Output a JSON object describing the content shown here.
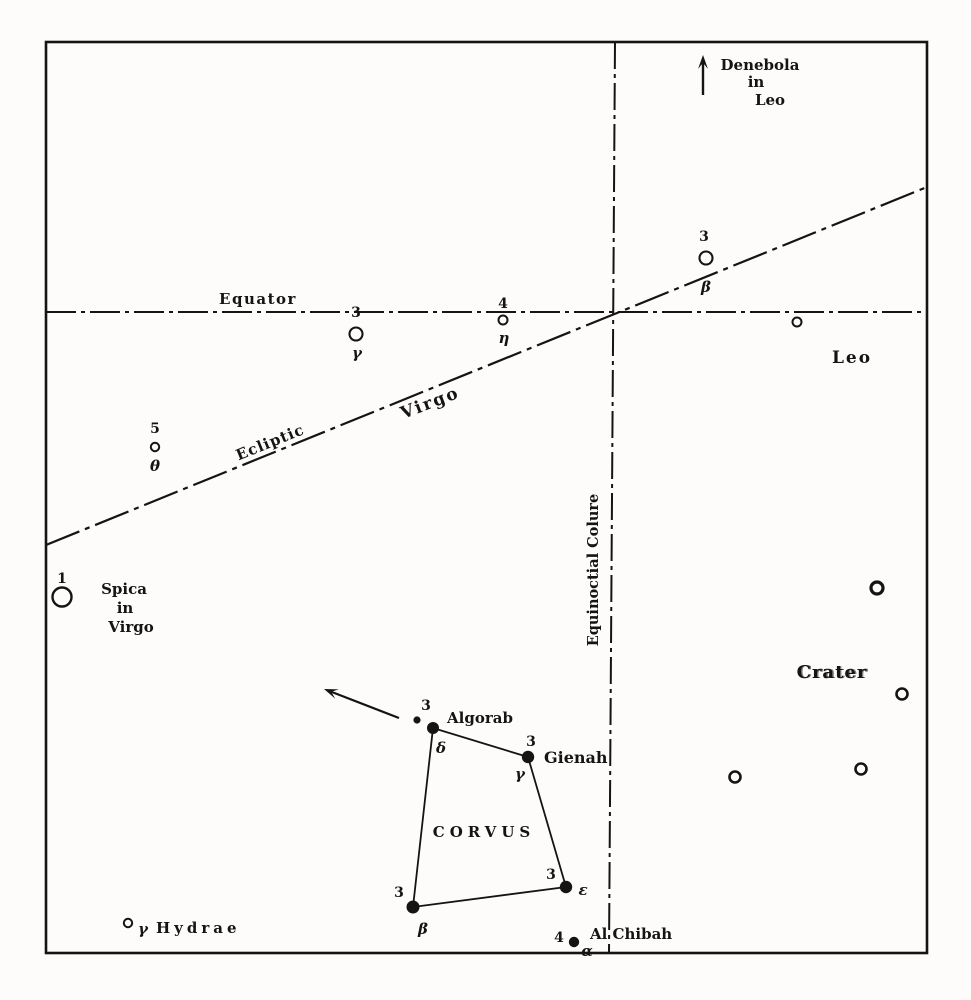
{
  "figure": {
    "description": "Vintage star chart of Corvus region with Virgo, Leo, Crater and Hydra",
    "canvas": {
      "width": 971,
      "height": 1000,
      "paper": "#fdfcfa",
      "ink": "#151413"
    },
    "frame": {
      "x": 46,
      "y": 42,
      "width": 881,
      "height": 911,
      "stroke_width": 2.6
    },
    "reference_lines": [
      {
        "id": "equator-line",
        "x1": 46,
        "y1": 312,
        "x2": 927,
        "y2": 312,
        "dash": "30 5 4 5",
        "width": 2.1
      },
      {
        "id": "ecliptic-line",
        "x1": 46,
        "y1": 545,
        "x2": 927,
        "y2": 187,
        "dash": "36 6 5 6",
        "width": 2.2
      },
      {
        "id": "equinoctial-colure-line",
        "x1": 615,
        "y1": 42,
        "x2": 609,
        "y2": 953,
        "dash": "27 5 4 5",
        "width": 2.0
      }
    ],
    "constellation_figure": {
      "id": "corvus-quadrilateral",
      "points": [
        [
          433,
          728
        ],
        [
          528,
          757
        ],
        [
          566,
          887
        ],
        [
          413,
          907
        ]
      ],
      "closed": true,
      "width": 1.8
    },
    "arrows": [
      {
        "id": "denebola-direction-arrow",
        "x1": 703,
        "y1": 95,
        "x2": 703,
        "y2": 55,
        "width": 2.4
      },
      {
        "id": "algorab-direction-arrow",
        "x1": 399,
        "y1": 718,
        "x2": 324,
        "y2": 689,
        "width": 2.2
      }
    ],
    "stars": [
      {
        "id": "beta-virginis-star",
        "type": "open",
        "x": 706,
        "y": 258,
        "r": 6.5,
        "ring": 2.1
      },
      {
        "id": "gamma-virginis-star",
        "type": "open",
        "x": 356,
        "y": 334,
        "r": 6.5,
        "ring": 2.1
      },
      {
        "id": "eta-virginis-star",
        "type": "open",
        "x": 503,
        "y": 320,
        "r": 4.5,
        "ring": 2.0
      },
      {
        "id": "leo-unnamed-star",
        "type": "open",
        "x": 797,
        "y": 322,
        "r": 4.5,
        "ring": 2.0
      },
      {
        "id": "theta-virginis-star",
        "type": "open",
        "x": 155,
        "y": 447,
        "r": 4.2,
        "ring": 2.0
      },
      {
        "id": "spica-star",
        "type": "open",
        "x": 62,
        "y": 597,
        "r": 9.5,
        "ring": 2.4
      },
      {
        "id": "crater-star-1",
        "type": "open",
        "x": 877,
        "y": 588,
        "r": 6.0,
        "ring": 3.2
      },
      {
        "id": "crater-star-2",
        "type": "open",
        "x": 902,
        "y": 694,
        "r": 5.5,
        "ring": 2.6
      },
      {
        "id": "crater-star-3",
        "type": "open",
        "x": 861,
        "y": 769,
        "r": 5.5,
        "ring": 2.6
      },
      {
        "id": "crater-star-4",
        "type": "open",
        "x": 735,
        "y": 777,
        "r": 5.5,
        "ring": 2.6
      },
      {
        "id": "gamma-hydrae-star",
        "type": "open",
        "x": 128,
        "y": 923,
        "r": 4.2,
        "ring": 2.0
      },
      {
        "id": "delta-corvi-algorab-star",
        "type": "filled",
        "x": 433,
        "y": 728,
        "r": 6.0
      },
      {
        "id": "algorab-companion-star",
        "type": "filled",
        "x": 417,
        "y": 720,
        "r": 3.6
      },
      {
        "id": "gamma-corvi-gienah-star",
        "type": "filled",
        "x": 528,
        "y": 757,
        "r": 6.2
      },
      {
        "id": "epsilon-corvi-star",
        "type": "filled",
        "x": 566,
        "y": 887,
        "r": 6.2
      },
      {
        "id": "beta-corvi-star",
        "type": "filled",
        "x": 413,
        "y": 907,
        "r": 6.5
      },
      {
        "id": "alpha-corvi-alchibah-star",
        "type": "filled",
        "x": 574,
        "y": 942,
        "r": 5.2
      }
    ],
    "labels": [
      {
        "id": "denebola-label-line1",
        "text": "Denebola",
        "x": 760,
        "y": 70,
        "size": 15
      },
      {
        "id": "denebola-label-line2",
        "text": "in",
        "x": 756,
        "y": 87,
        "size": 15
      },
      {
        "id": "denebola-label-line3",
        "text": "Leo",
        "x": 770,
        "y": 105,
        "size": 15
      },
      {
        "id": "beta-virginis-magnitude",
        "text": "3",
        "x": 704,
        "y": 241,
        "size": 14
      },
      {
        "id": "beta-virginis-letter",
        "text": "β",
        "x": 706,
        "y": 292,
        "size": 15,
        "italic": true
      },
      {
        "id": "equator-label",
        "text": "Equator",
        "x": 258,
        "y": 304,
        "size": 15,
        "ls": 1.5
      },
      {
        "id": "gamma-virginis-magnitude",
        "text": "3",
        "x": 356,
        "y": 317,
        "size": 14
      },
      {
        "id": "gamma-virginis-letter",
        "text": "γ",
        "x": 357,
        "y": 358,
        "size": 15,
        "italic": true
      },
      {
        "id": "eta-virginis-magnitude",
        "text": "4",
        "x": 503,
        "y": 308,
        "size": 14
      },
      {
        "id": "eta-virginis-letter",
        "text": "η",
        "x": 504,
        "y": 343,
        "size": 15,
        "italic": true
      },
      {
        "id": "leo-label",
        "text": "Leo",
        "x": 852,
        "y": 363,
        "size": 17,
        "ls": 2
      },
      {
        "id": "virgo-label",
        "text": "Virgo",
        "x": 432,
        "y": 408,
        "size": 17,
        "ls": 2,
        "rotate": -21
      },
      {
        "id": "ecliptic-label",
        "text": "Ecliptic",
        "x": 272,
        "y": 447,
        "size": 15,
        "ls": 1,
        "rotate": -22
      },
      {
        "id": "theta-virginis-magnitude",
        "text": "5",
        "x": 155,
        "y": 433,
        "size": 14
      },
      {
        "id": "theta-virginis-letter",
        "text": "θ",
        "x": 155,
        "y": 471,
        "size": 15,
        "italic": true
      },
      {
        "id": "spica-magnitude",
        "text": "1",
        "x": 62,
        "y": 583,
        "size": 14
      },
      {
        "id": "spica-label-line1",
        "text": "Spica",
        "x": 124,
        "y": 594,
        "size": 15
      },
      {
        "id": "spica-label-line2",
        "text": "in",
        "x": 125,
        "y": 613,
        "size": 15
      },
      {
        "id": "spica-label-line3",
        "text": "Virgo",
        "x": 131,
        "y": 632,
        "size": 15
      },
      {
        "id": "equinoctial-colure-label",
        "text": "Equinoctial Colure",
        "x": 598,
        "y": 570,
        "size": 14.5,
        "rotate": -90
      },
      {
        "id": "crater-label",
        "text": "Crater",
        "x": 832,
        "y": 678,
        "size": 18,
        "ls": 1,
        "smudge": true
      },
      {
        "id": "corvus-label",
        "text": "CORVUS",
        "x": 484,
        "y": 837,
        "size": 15,
        "ls": 5
      },
      {
        "id": "algorab-magnitude",
        "text": "3",
        "x": 426,
        "y": 710,
        "size": 14
      },
      {
        "id": "algorab-name",
        "text": "Algorab",
        "x": 447,
        "y": 723,
        "size": 15,
        "anchor": "start"
      },
      {
        "id": "delta-corvi-letter",
        "text": "δ",
        "x": 441,
        "y": 753,
        "size": 15,
        "italic": true
      },
      {
        "id": "gienah-magnitude",
        "text": "3",
        "x": 531,
        "y": 746,
        "size": 14
      },
      {
        "id": "gienah-name",
        "text": "Gienah",
        "x": 544,
        "y": 763,
        "size": 16,
        "anchor": "start"
      },
      {
        "id": "gamma-corvi-letter",
        "text": "γ",
        "x": 520,
        "y": 779,
        "size": 15,
        "italic": true
      },
      {
        "id": "epsilon-corvi-magnitude",
        "text": "3",
        "x": 551,
        "y": 879,
        "size": 14
      },
      {
        "id": "epsilon-corvi-letter",
        "text": "ε",
        "x": 583,
        "y": 895,
        "size": 15,
        "italic": true
      },
      {
        "id": "beta-corvi-magnitude",
        "text": "3",
        "x": 399,
        "y": 897,
        "size": 14
      },
      {
        "id": "beta-corvi-letter",
        "text": "β",
        "x": 423,
        "y": 934,
        "size": 15,
        "italic": true
      },
      {
        "id": "alchibah-magnitude",
        "text": "4",
        "x": 559,
        "y": 942,
        "size": 14
      },
      {
        "id": "alchibah-name",
        "text": "Al Chibah",
        "x": 590,
        "y": 939,
        "size": 15,
        "anchor": "start"
      },
      {
        "id": "alpha-corvi-letter",
        "text": "α",
        "x": 587,
        "y": 956,
        "size": 15,
        "italic": true
      },
      {
        "id": "gamma-hydrae-letter",
        "text": "γ",
        "x": 143,
        "y": 934,
        "size": 15,
        "italic": true
      },
      {
        "id": "gamma-hydrae-name",
        "text": "Hydrae",
        "x": 156,
        "y": 933,
        "size": 15,
        "ls": 4,
        "anchor": "start"
      }
    ]
  }
}
